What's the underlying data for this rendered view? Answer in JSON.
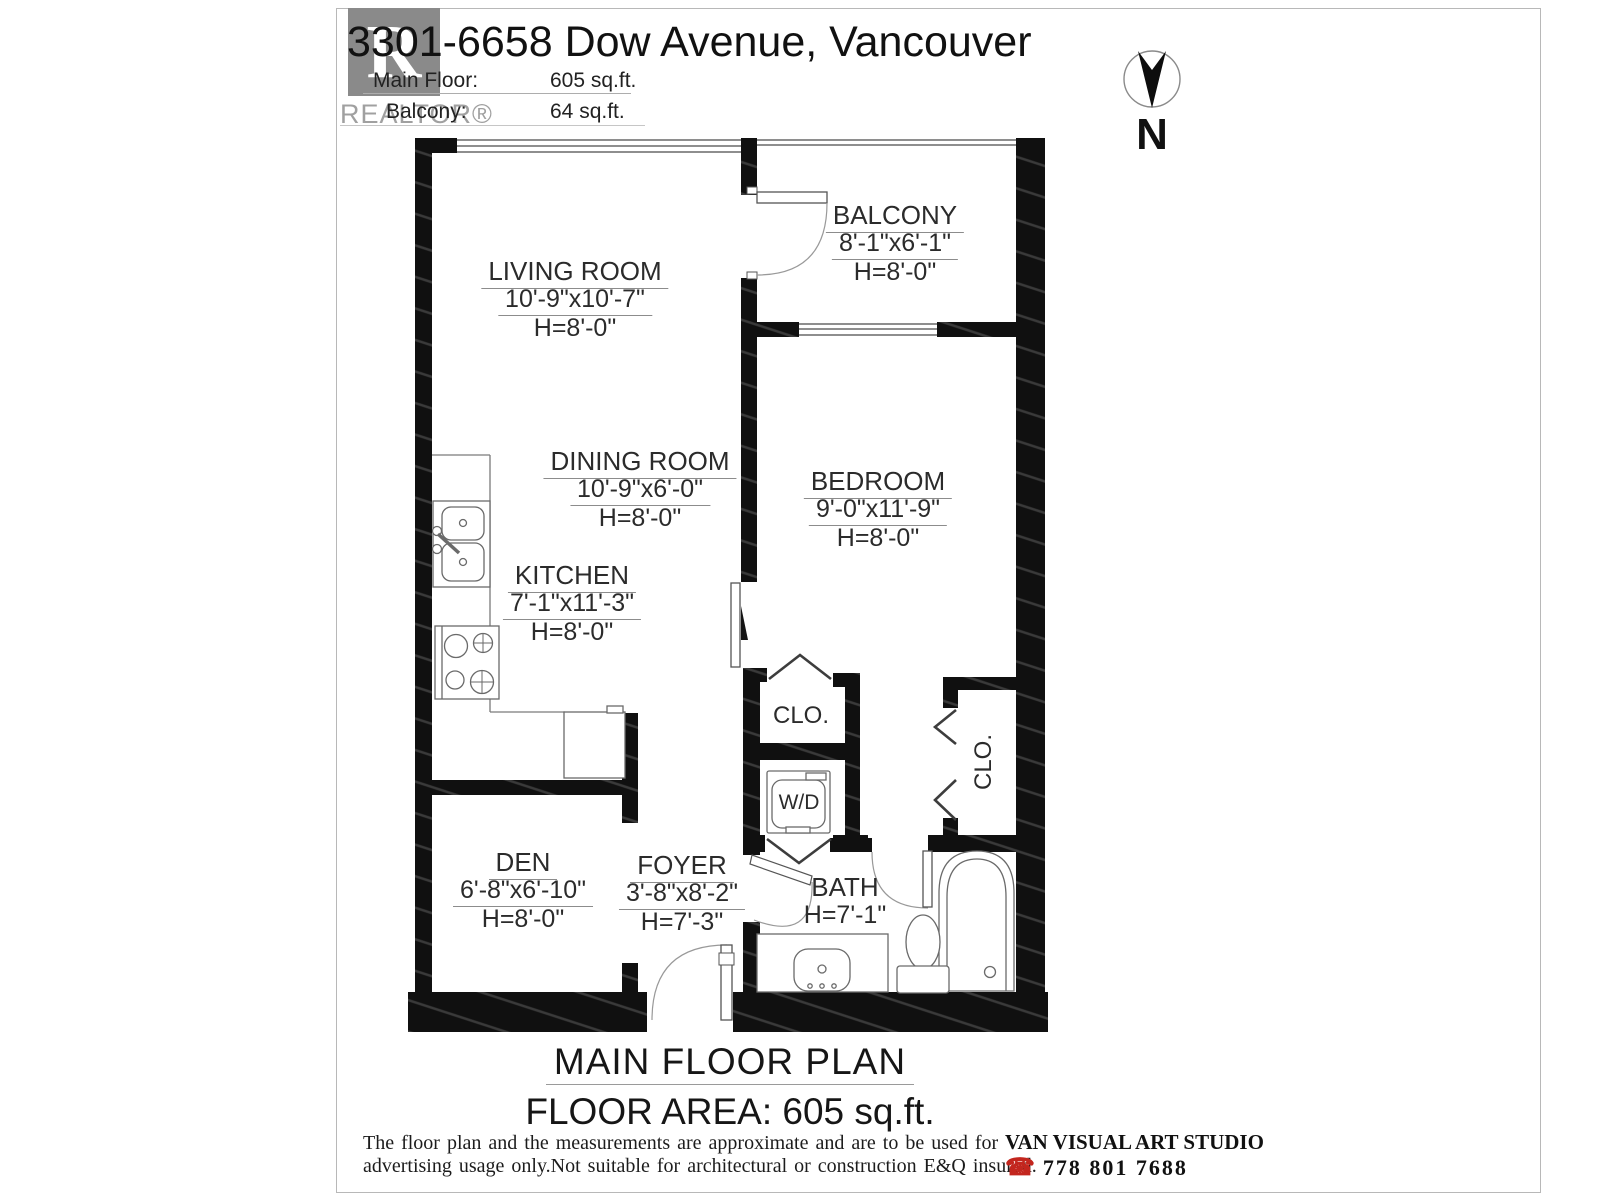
{
  "header": {
    "title": "3301-6658 Dow Avenue, Vancouver",
    "main_floor_label": "Main Floor:",
    "main_floor_value": "605 sq.ft.",
    "balcony_label": "Balcony:",
    "balcony_value": "64 sq.ft.",
    "logo": {
      "letter": "R",
      "wordmark": "REALTOR®"
    },
    "compass": {
      "label": "N"
    }
  },
  "rooms": [
    {
      "name": "LIVING ROOM",
      "dims": "10'-9\"x10'-7\"",
      "height": "H=8'-0\""
    },
    {
      "name": "BALCONY",
      "dims": "8'-1\"x6'-1\"",
      "height": "H=8'-0\""
    },
    {
      "name": "DINING ROOM",
      "dims": "10'-9\"x6'-0\"",
      "height": "H=8'-0\""
    },
    {
      "name": "BEDROOM",
      "dims": "9'-0\"x11'-9\"",
      "height": "H=8'-0\""
    },
    {
      "name": "KITCHEN",
      "dims": "7'-1\"x11'-3\"",
      "height": "H=8'-0\""
    },
    {
      "name": "DEN",
      "dims": "6'-8\"x6'-10\"",
      "height": "H=8'-0\""
    },
    {
      "name": "FOYER",
      "dims": "3'-8\"x8'-2\"",
      "height": "H=7'-3\""
    },
    {
      "name": "BATH",
      "height": "H=7'-1\""
    },
    {
      "name": "CLO."
    },
    {
      "name": "CLO."
    },
    {
      "name": "W/D"
    }
  ],
  "footer": {
    "plan_title": "MAIN FLOOR PLAN",
    "floor_area": "FLOOR AREA: 605 sq.ft.",
    "disclaimer_line1": "The floor plan and the measurements are approximate and are to be used for",
    "disclaimer_line2": "advertising usage only.Not suitable for architectural or construction E&Q insured.",
    "studio": "VAN VISUAL ART STUDIO",
    "phone_icon": "☎",
    "phone": "778 801 7688"
  },
  "colors": {
    "wall": "#101010",
    "accent_phone": "#c3261e"
  }
}
